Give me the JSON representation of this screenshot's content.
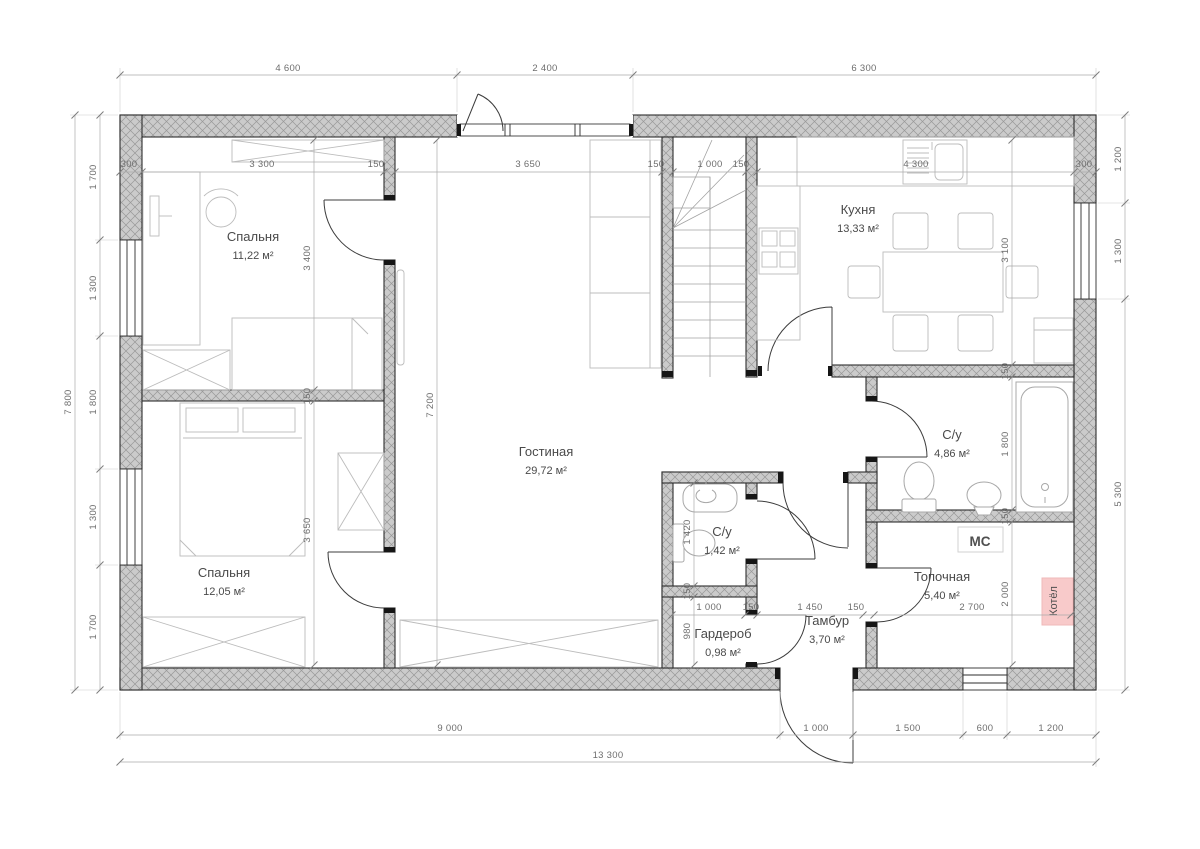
{
  "plan": {
    "rooms": {
      "bedroom1": {
        "name": "Спальня",
        "area": "11,22 м²"
      },
      "bedroom2": {
        "name": "Спальня",
        "area": "12,05 м²"
      },
      "living": {
        "name": "Гостиная",
        "area": "29,72 м²"
      },
      "kitchen": {
        "name": "Кухня",
        "area": "13,33 м²"
      },
      "bathroom": {
        "name": "С/у",
        "area": "4,86 м²"
      },
      "wc": {
        "name": "С/у",
        "area": "1,42 м²"
      },
      "boiler_room": {
        "name": "Топочная",
        "area": "5,40 м²"
      },
      "wardrobe": {
        "name": "Гардероб",
        "area": "0,98 м²"
      },
      "tambour": {
        "name": "Тамбур",
        "area": "3,70 м²"
      }
    },
    "equipment": {
      "mc": "МС",
      "boiler": "Котёл"
    },
    "dims": {
      "top": [
        "4 600",
        "2 400",
        "6 300"
      ],
      "top_inner": [
        "300",
        "3 300",
        "150",
        "3 650",
        "150",
        "1 000",
        "150",
        "4 300",
        "300"
      ],
      "left": [
        "1 700",
        "1 300",
        "1 800",
        "1 300",
        "1 700"
      ],
      "left_overall": "7 800",
      "right": [
        "1 200",
        "1 300",
        "5 300"
      ],
      "bottom": [
        "9 000",
        "1 000",
        "1 500",
        "600",
        "1 200"
      ],
      "bottom_overall": "13 300",
      "bedroom_col": [
        "3 400",
        "150",
        "3 650"
      ],
      "living_col": [
        "7 200"
      ],
      "kitchen_col": [
        "3 100",
        "150",
        "1 800",
        "150",
        "2 000"
      ],
      "hall_row": [
        "1 000",
        "150",
        "1 450",
        "150",
        "2 700"
      ],
      "wc_col": [
        "1 420",
        "150",
        "980"
      ]
    },
    "colors": {
      "accent_magenta": "#b5256b",
      "boiler_fill": "#f8caca",
      "boiler_text": "#a05252",
      "wall_fill": "#cbcbcb"
    }
  }
}
